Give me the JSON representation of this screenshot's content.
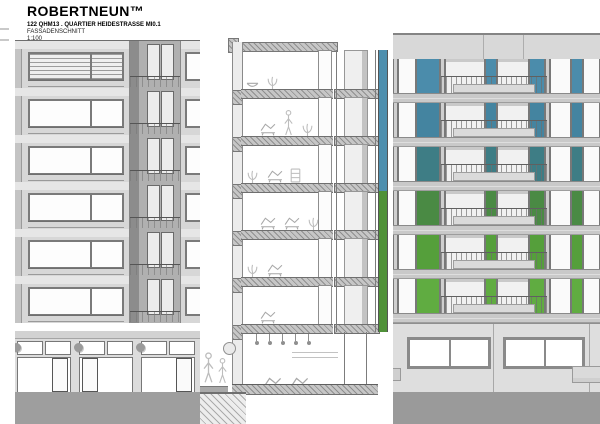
{
  "header": {
    "title": "ROBERTNEUN™",
    "project": "122 QHM13 . QUARTIER HEIDESTRASSE MI0.1",
    "drawing_type": "FASSADENSCHNITT",
    "scale": "1:100"
  },
  "palette": {
    "facade_grey": "#d7d7d7",
    "slab_light": "#e6e6e6",
    "loggia_grey": "#b0b0b0",
    "frame_grey": "#7a7a7a",
    "ground_grey": "#9e9e9e",
    "parapet_grey": "#d8d8d8",
    "band_grey": "#c9c9c9",
    "section_blue_strip": "#4e8fae",
    "section_green_strip": "#4f9138"
  },
  "left_elevation": {
    "label": "street facade elevation",
    "floors": 6,
    "top_floor_louvers": true,
    "storefront_bays": 3
  },
  "section": {
    "label": "facade section",
    "floors": 6,
    "floor_items": [
      [
        "bowl",
        "plant"
      ],
      [
        "chair",
        "person",
        "plant"
      ],
      [
        "plant",
        "chair",
        "shelf"
      ],
      [
        "chair",
        "chair",
        "plant"
      ],
      [
        "plant",
        "chair"
      ],
      [
        "chair"
      ]
    ],
    "pendants": 5,
    "ground_chairs": 2,
    "outside_people": 2
  },
  "right_elevation": {
    "label": "courtyard facade elevation",
    "floors": 6,
    "floor_colors": [
      "#4b8cab",
      "#4484a0",
      "#3e7d85",
      "#4a8a44",
      "#559f3b",
      "#60ac41"
    ]
  }
}
